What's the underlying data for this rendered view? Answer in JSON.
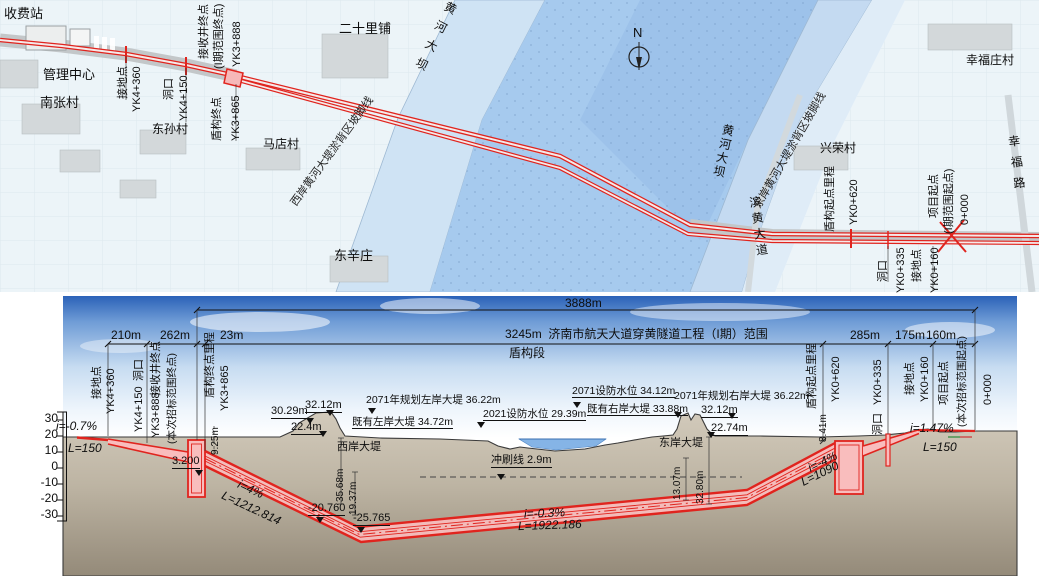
{
  "title": "济南市航天大道穿黄隧道工程（I期）平面及纵断面图",
  "colors": {
    "route_red": "#e0241e",
    "tunnel_pink": "#f9bdbd",
    "river": "#a6caee",
    "flood_west": "#cfe3f4",
    "flood_east": "#c4daf1",
    "sky_top": "#2b62b8",
    "ground": "#bdb4a3",
    "water_profile": "#85b4e6"
  },
  "map": {
    "labels": [
      {
        "t": "收费站",
        "x": 4,
        "y": 7,
        "fs": 13,
        "n": "toll-station-label"
      },
      {
        "t": "管理中心",
        "x": 43,
        "y": 68,
        "fs": 13,
        "n": "management-center-label"
      },
      {
        "t": "南张村",
        "x": 40,
        "y": 96,
        "fs": 13,
        "n": "nanzhang-village-label"
      },
      {
        "t": "东孙村",
        "x": 152,
        "y": 123,
        "fs": 12,
        "n": "dongsun-village-label"
      },
      {
        "t": "马店村",
        "x": 263,
        "y": 138,
        "fs": 12,
        "n": "madian-village-label"
      },
      {
        "t": "二十里铺",
        "x": 339,
        "y": 22,
        "fs": 13,
        "n": "ershilipu-label"
      },
      {
        "t": "东辛庄",
        "x": 334,
        "y": 249,
        "fs": 13,
        "n": "dongxinzhuang-label"
      },
      {
        "t": "幸福庄村",
        "x": 966,
        "y": 54,
        "fs": 12,
        "n": "xingfuzhuang-village-label"
      },
      {
        "t": "兴荣村",
        "x": 820,
        "y": 142,
        "fs": 12,
        "n": "xingrong-village-label"
      },
      {
        "t": "N",
        "x": 633,
        "y": 26,
        "fs": 13,
        "n": "compass-north-label"
      }
    ],
    "vlabels": [
      {
        "t": "黄河大坝",
        "x": 446,
        "y": 2,
        "ls": 9,
        "rot": 27,
        "n": "yellow-river-dam-west-label"
      },
      {
        "t": "黄河大坝",
        "x": 722,
        "y": 124,
        "ls": 2,
        "rot": 12,
        "n": "yellow-river-dam-east-label"
      },
      {
        "t": "滨黄大道",
        "x": 747,
        "y": 196,
        "ls": 4,
        "rot": -8,
        "n": "binhuang-avenue-label"
      },
      {
        "t": "幸福路",
        "x": 1006,
        "y": 135,
        "ls": 9,
        "rot": -7,
        "n": "xingfu-road-label"
      }
    ],
    "dlabels": [
      {
        "t": "西岸黄河大堤淤背区坡脚线",
        "x": 333,
        "y": 152,
        "rot": -54,
        "n": "west-dike-toe-line-label"
      },
      {
        "t": "东岸黄河大堤淤背区坡脚线",
        "x": 791,
        "y": 151,
        "rot": -60,
        "n": "east-dike-toe-line-label"
      }
    ],
    "rlabels": [
      {
        "t": "接地点",
        "x": 118,
        "y": 99
      },
      {
        "t": "YK4+360",
        "x": 132,
        "y": 112
      },
      {
        "t": "洞口",
        "x": 164,
        "y": 100
      },
      {
        "t": "YK4+150",
        "x": 179,
        "y": 121
      },
      {
        "t": "接收井终点",
        "x": 199,
        "y": 59
      },
      {
        "t": "(I期范围终点)",
        "x": 214,
        "y": 69
      },
      {
        "t": "YK3+888",
        "x": 232,
        "y": 67
      },
      {
        "t": "盾构终点",
        "x": 212,
        "y": 141
      },
      {
        "t": "YK3+865",
        "x": 231,
        "y": 141
      },
      {
        "t": "盾构起点里程",
        "x": 825,
        "y": 232
      },
      {
        "t": "YK0+620",
        "x": 849,
        "y": 225
      },
      {
        "t": "项目起点",
        "x": 929,
        "y": 218
      },
      {
        "t": "(I期范围起点)",
        "x": 944,
        "y": 234
      },
      {
        "t": "0+000",
        "x": 960,
        "y": 225
      },
      {
        "t": "洞口",
        "x": 878,
        "y": 282
      },
      {
        "t": "YK0+335",
        "x": 896,
        "y": 293
      },
      {
        "t": "接地点",
        "x": 912,
        "y": 282
      },
      {
        "t": "YK0+160",
        "x": 930,
        "y": 293
      }
    ]
  },
  "profile": {
    "labels": [
      {
        "t": "3888m",
        "x": 565,
        "y": 297,
        "fs": 12,
        "n": "total-length-dim"
      },
      {
        "t": "3245m  济南市航天大道穿黄隧道工程（I期）范围",
        "x": 505,
        "y": 328,
        "fs": 12,
        "n": "project-range-dim"
      },
      {
        "t": "盾构段",
        "x": 509,
        "y": 347,
        "fs": 12,
        "n": "shield-section-label"
      },
      {
        "t": "210m",
        "x": 111,
        "y": 329,
        "fs": 12
      },
      {
        "t": "262m",
        "x": 160,
        "y": 329,
        "fs": 12
      },
      {
        "t": "23m",
        "x": 220,
        "y": 329,
        "fs": 12
      },
      {
        "t": "285m",
        "x": 850,
        "y": 329,
        "fs": 12
      },
      {
        "t": "175m",
        "x": 895,
        "y": 329,
        "fs": 12
      },
      {
        "t": "160m",
        "x": 926,
        "y": 329,
        "fs": 12
      },
      {
        "t": "i=-0.7%",
        "x": 56,
        "y": 420,
        "fs": 12,
        "i": 1
      },
      {
        "t": "L=150",
        "x": 68,
        "y": 442,
        "fs": 12,
        "i": 1
      },
      {
        "t": "2071年规划左岸大堤 36.22m",
        "x": 366,
        "y": 395,
        "fs": 10.5
      },
      {
        "t": "30.29m",
        "x": 271,
        "y": 406,
        "fs": 11,
        "u": 1
      },
      {
        "t": "32.12m",
        "x": 305,
        "y": 400,
        "fs": 11,
        "u": 1
      },
      {
        "t": "22.4m",
        "x": 291,
        "y": 422,
        "fs": 11,
        "u": 1
      },
      {
        "t": "既有左岸大堤 34.72m",
        "x": 352,
        "y": 417,
        "fs": 10.5,
        "u": 1
      },
      {
        "t": "西岸大堤",
        "x": 337,
        "y": 442,
        "fs": 11
      },
      {
        "t": "2021设防水位 29.39m",
        "x": 483,
        "y": 409,
        "fs": 10.5,
        "u": 1
      },
      {
        "t": "2071设防水位 34.12m",
        "x": 572,
        "y": 386,
        "fs": 10.5,
        "u": 1
      },
      {
        "t": "既有右岸大堤 33.88m",
        "x": 587,
        "y": 404,
        "fs": 10.5,
        "u": 1
      },
      {
        "t": "2071年规划右岸大堤 36.22m",
        "x": 674,
        "y": 391,
        "fs": 10.5
      },
      {
        "t": "32.12m",
        "x": 701,
        "y": 405,
        "fs": 11,
        "u": 1
      },
      {
        "t": "22.74m",
        "x": 711,
        "y": 423,
        "fs": 11,
        "u": 1
      },
      {
        "t": "东岸大堤",
        "x": 659,
        "y": 438,
        "fs": 11
      },
      {
        "t": "冲刷线 2.9m",
        "x": 491,
        "y": 455,
        "fs": 11,
        "u": 1
      },
      {
        "t": "3.200",
        "x": 172,
        "y": 456,
        "fs": 11,
        "u": 1
      },
      {
        "t": "-20.760",
        "x": 308,
        "y": 503,
        "fs": 11,
        "u": 1
      },
      {
        "t": "-25.765",
        "x": 353,
        "y": 513,
        "fs": 11,
        "u": 1
      },
      {
        "t": "i=-0.3%",
        "x": 524,
        "y": 507,
        "fs": 12,
        "i": 1,
        "rot": -2
      },
      {
        "t": "L=1922.186",
        "x": 518,
        "y": 519,
        "fs": 12,
        "i": 1,
        "rot": -2
      },
      {
        "t": "i=1.47%",
        "x": 910,
        "y": 422,
        "fs": 12,
        "i": 1
      },
      {
        "t": "L=150",
        "x": 923,
        "y": 441,
        "fs": 12,
        "i": 1
      }
    ],
    "rlabels": [
      {
        "t": "接地点",
        "x": 92,
        "y": 399
      },
      {
        "t": "YK4+360",
        "x": 106,
        "y": 414
      },
      {
        "t": "洞口",
        "x": 134,
        "y": 381
      },
      {
        "t": "YK4+150",
        "x": 134,
        "y": 432
      },
      {
        "t": "接收井终点",
        "x": 151,
        "y": 396
      },
      {
        "t": "YK3+888",
        "x": 151,
        "y": 438
      },
      {
        "t": "(本次招标范围终点)",
        "x": 167,
        "y": 444,
        "fs": 10.5
      },
      {
        "t": "盾构终点里程",
        "x": 205,
        "y": 398
      },
      {
        "t": "YK3+865",
        "x": 220,
        "y": 411
      },
      {
        "t": "9.25m",
        "x": 211,
        "y": 455,
        "fs": 10
      },
      {
        "t": "35.68m",
        "x": 336,
        "y": 502,
        "fs": 10
      },
      {
        "t": "19.37m",
        "x": 349,
        "y": 515,
        "fs": 10
      },
      {
        "t": "13.07m",
        "x": 673,
        "y": 500,
        "fs": 10
      },
      {
        "t": "32.80m",
        "x": 696,
        "y": 504,
        "fs": 10
      },
      {
        "t": "盾构起点里程",
        "x": 807,
        "y": 409
      },
      {
        "t": "YK0+620",
        "x": 831,
        "y": 402
      },
      {
        "t": "8.41m",
        "x": 819,
        "y": 442,
        "fs": 10
      },
      {
        "t": "YK0+335",
        "x": 873,
        "y": 405
      },
      {
        "t": "洞口",
        "x": 873,
        "y": 435
      },
      {
        "t": "接地点",
        "x": 905,
        "y": 395
      },
      {
        "t": "YK0+160",
        "x": 920,
        "y": 402
      },
      {
        "t": "项目起点",
        "x": 939,
        "y": 405
      },
      {
        "t": "(本次招标范围起点)",
        "x": 957,
        "y": 427,
        "fs": 10.5
      },
      {
        "t": "0+000",
        "x": 983,
        "y": 405
      }
    ],
    "slopes": [
      {
        "t": "i=4%",
        "x": 241,
        "y": 478,
        "rot": 25,
        "i": 1,
        "fs": 12
      },
      {
        "t": "L=1212.814",
        "x": 225,
        "y": 489,
        "rot": 25,
        "i": 1,
        "fs": 12
      },
      {
        "t": "i=-4%",
        "x": 806,
        "y": 463,
        "rot": -26,
        "i": 1,
        "fs": 12
      },
      {
        "t": "L=1090",
        "x": 799,
        "y": 477,
        "rot": -26,
        "i": 1,
        "fs": 12
      }
    ],
    "elev": [
      {
        "t": "30",
        "x": 34,
        "y": 412
      },
      {
        "t": "20",
        "x": 34,
        "y": 428
      },
      {
        "t": "10",
        "x": 34,
        "y": 444
      },
      {
        "t": "0",
        "x": 34,
        "y": 460
      },
      {
        "t": "-10",
        "x": 34,
        "y": 476
      },
      {
        "t": "-20",
        "x": 34,
        "y": 492
      },
      {
        "t": "-30",
        "x": 34,
        "y": 508
      }
    ]
  }
}
